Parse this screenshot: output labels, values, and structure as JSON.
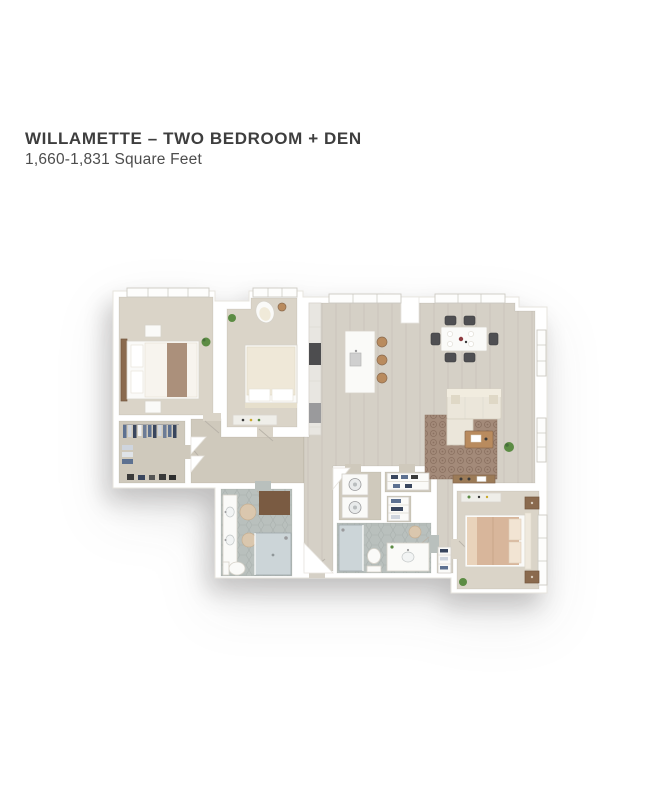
{
  "header": {
    "title": "WILLAMETTE – TWO BEDROOM + DEN",
    "subtitle": "1,660-1,831 Square Feet"
  },
  "floorplan": {
    "style": "3d-top-down-render, unlabeled",
    "rooms": [
      "primary-bedroom",
      "bedroom-2",
      "den-nook",
      "walk-in-closet",
      "primary-bathroom",
      "bathroom-2",
      "laundry-closet",
      "pantry-closet",
      "linen-closet",
      "kitchen",
      "dining-area",
      "living-room",
      "entry-hallway",
      "master-suite-bedroom"
    ],
    "fixtures": [
      "bed",
      "bed",
      "bed",
      "armchair",
      "kitchen-island",
      "bar-stools",
      "dining-table-six-chairs",
      "sectional-sofa",
      "area-rug",
      "coffee-table",
      "media-console",
      "double-vanity",
      "toilet",
      "toilet",
      "shower",
      "shower",
      "washer-dryer-stack",
      "windows",
      "plants"
    ]
  },
  "colors": {
    "page_bg": "#ffffff",
    "title": "#3e3e3e",
    "subtitle": "#4d4d4d",
    "wall": "#ffffff",
    "wall_line": "#e7e4de",
    "floor_main": "#d5d0c6",
    "floor_bed": "#dad4c8",
    "floor_closet": "#cfc9bc",
    "tile": "#b9c0bd",
    "tile_line": "#a9b1ae",
    "rug": "#a38a79",
    "rug_dot": "#8a7060",
    "sofa": "#ebe6da",
    "cream": "#f0ead9",
    "bed_white": "#f6f3ec",
    "bed_tan": "#d8b69b",
    "bed_throw": "#ab907b",
    "wood": "#b98b5e",
    "wood_dark": "#8a6a4e",
    "wood_deep": "#7a5b42",
    "white_furn": "#fafaf8",
    "counter": "#efeee9",
    "cabinet": "#e8e6e1",
    "appliance": "#4d4d4f",
    "steel": "#9a9a9c",
    "chair": "#4f4f52",
    "glass": "#ccd5d8",
    "glass_line": "#9fa8ab",
    "plant": "#5c8c44",
    "plant_dark": "#47703a",
    "accent_red": "#8d3b3f",
    "bath_rug": "#dac7ae",
    "bath_rug_line": "#c6af92",
    "textile_blue": "#5d7191",
    "textile_navy": "#39465e",
    "textile_light": "#cfd5de",
    "dark_item": "#3a3a3a"
  }
}
